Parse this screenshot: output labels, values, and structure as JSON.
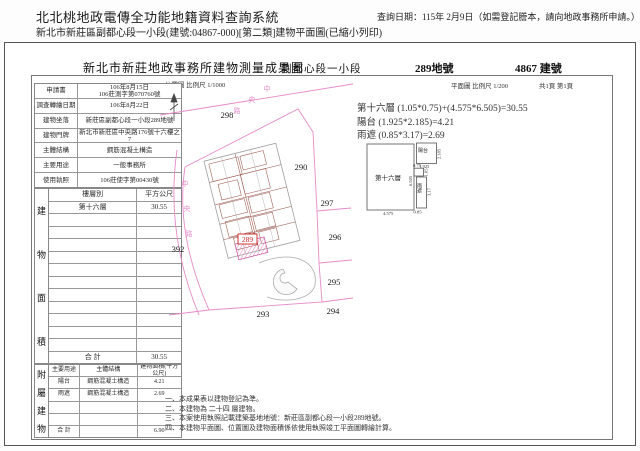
{
  "page": {
    "title": "北北桃地政電傳全功能地籍資料查詢系統",
    "query_date": "查詢日期：115年 2月9日（如需登記謄本，請向地政事務所申請。）",
    "subtitle": "新北市新莊區副都心段一小段(建號:04867-000)[第二類]建物平面圖(已縮小列印)"
  },
  "document": {
    "header": {
      "office_title": "新北市新莊地政事務所建物測量成果圖",
      "section": "副都心段一小段",
      "land_no": "289地號",
      "building_no": "4867 建號"
    },
    "scales": {
      "location_map": "位置圖 比例尺 1/1000",
      "floor_plan": "平面圖 比例尺 1/200",
      "pages": "共1頁 第1頁"
    },
    "info_table": {
      "rows": [
        {
          "label": "申請書",
          "value": "106年8月15日\n106莊測字第070760號"
        },
        {
          "label": "調查轉繪日期",
          "value": "106年8月22日"
        },
        {
          "label": "建物坐落",
          "value": "新莊區副都心段一小段289地號"
        },
        {
          "label": "建物門牌",
          "value": "新北市新莊區中央路176號十六樓之7"
        },
        {
          "label": "主體結構",
          "value": "鋼筋混凝土構造"
        },
        {
          "label": "主要用途",
          "value": "一般事務所"
        },
        {
          "label": "使用執照",
          "value": "106莊使字第00430號"
        }
      ]
    },
    "area_table": {
      "side_label": "建物面積",
      "col_floor": "樓層別",
      "col_area": "平方公尺",
      "rows": [
        {
          "floor": "第十六層",
          "area": "30.55"
        }
      ],
      "empty_rows": 11,
      "total_label": "合  計",
      "total": "30.55"
    },
    "annex_table": {
      "side_label": "附屬建物",
      "columns": [
        "主要用途",
        "主體結構",
        "建物面積(平方公尺)"
      ],
      "rows": [
        {
          "use": "陽台",
          "structure": "鋼筋混凝土構造",
          "area": "4.21"
        },
        {
          "use": "雨遮",
          "structure": "鋼筋混凝土構造",
          "area": "2.69"
        }
      ],
      "empty_rows": 2,
      "total_label": "合  計",
      "total": "6.90"
    },
    "site_map": {
      "subject_lot": "289",
      "lots": [
        {
          "no": "298",
          "x": 226,
          "y": 117
        },
        {
          "no": "290",
          "x": 300,
          "y": 169
        },
        {
          "no": "297",
          "x": 326,
          "y": 205
        },
        {
          "no": "296",
          "x": 334,
          "y": 239
        },
        {
          "no": "295",
          "x": 333,
          "y": 284
        },
        {
          "no": "294",
          "x": 332,
          "y": 313
        },
        {
          "no": "293",
          "x": 262,
          "y": 316
        },
        {
          "no": "392",
          "x": 177,
          "y": 251
        }
      ],
      "road_labels": [
        {
          "ch": "中",
          "x": 266,
          "y": 90
        },
        {
          "ch": "央",
          "x": 251,
          "y": 101
        },
        {
          "ch": "路",
          "x": 236,
          "y": 112
        },
        {
          "ch": "中",
          "x": 184,
          "y": 185
        },
        {
          "ch": "央",
          "x": 186,
          "y": 210
        },
        {
          "ch": "路",
          "x": 188,
          "y": 235
        }
      ]
    },
    "unit_plan": {
      "room_label": "第十六層",
      "balcony_label": "陽台",
      "canopy_label": "雨遮",
      "dims": {
        "width": "4.575",
        "height": "6.505",
        "balcony_w": "1.925",
        "balcony_h": "2.185",
        "step_w": "0.75",
        "step_h": "1.05",
        "canopy_w": "0.85",
        "canopy_h": "3.17"
      }
    },
    "formulas": [
      "第十六層 (1.05*0.75)+(4.575*6.505)=30.55",
      "陽台 (1.925*2.185)=4.21",
      "雨遮 (0.85*3.17)=2.69"
    ],
    "notes": [
      "一、本成果表以建物登記為準。",
      "二、本建物為 二十四 層建物。",
      "三、本案使用執照記載建築基地地號：新莊區副都心段一小段289地號。",
      "四、本建物平面圖、位置圖及建物面積係依使用執照竣工平面圖轉繪計算。"
    ],
    "colors": {
      "boundary_pink": "#e68bc8",
      "subject_red": "#cc2222",
      "building_line": "#9a564c",
      "outline_gray": "#a0a0a0"
    }
  }
}
